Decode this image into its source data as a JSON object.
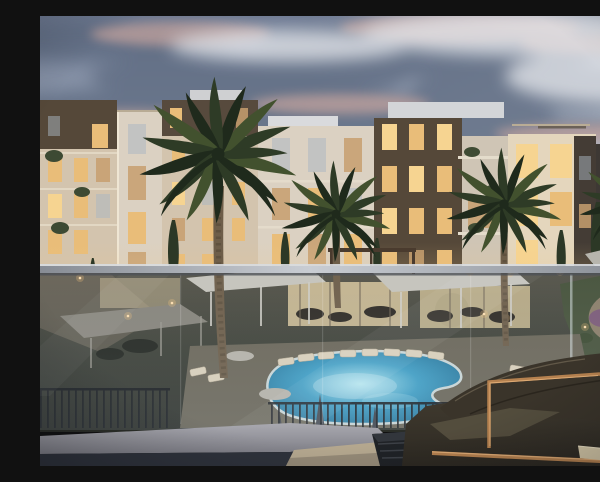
{
  "scene": {
    "setting": "Residential apartment compound at dusk viewed from a private balcony through a glass railing",
    "time_of_day": "dusk",
    "elements": [
      "evening sky with slate and pink-lit clouds",
      "four-to-five storey cream and dark-brown apartment buildings with warmly glowing windows and planted balconies",
      "tall palm trees and cypress trees",
      "white shade canopies and pergola pavilions in the courtyard",
      "illuminated free-form swimming pool with white coping",
      "rows of sun loungers and closed pool umbrellas",
      "lawn with winding path and purple and red flower beds",
      "dark picket pool fence",
      "full-width glass balustrade with metal handrail",
      "balcony ledge, side table and slatted box",
      "outdoor sofa with dark olive cushions, copper frame and light seat cushion"
    ],
    "counts": {
      "palm_trees": 4,
      "building_blocks": 8,
      "sun_loungers": 14,
      "pool_umbrellas": 6
    }
  },
  "palette": {
    "sky-top": "#6f7b93",
    "sky-mid": "#9aa5b7",
    "sky-low": "#c6cdd8",
    "sky-glow": "#dfe3e9",
    "cloud-dark": "#5f6c82",
    "cloud-pink": "#d8ada2",
    "cloud-light": "#e9ebef",
    "facade-cream": "#d3c4ae",
    "facade-light": "#e4d6bd",
    "facade-white": "#dbd1c2",
    "facade-dark": "#554839",
    "facade-charcoal": "#3d3834",
    "window-bright": "#f6d491",
    "window-lit": "#e9bd79",
    "window-dim": "#c79f6e",
    "window-cool": "#a9b6c2",
    "palm-dark": "#1f2a1c",
    "palm-mid": "#2e3b26",
    "palm-light": "#42512e",
    "trunk": "#6e5e49",
    "canopy-white": "#c7c5bd",
    "ground-dark": "#3c3f36",
    "deck": "#6b6658",
    "lawn": "#46523a",
    "path-warm": "#93836f",
    "pool-glow": "#aee8f2",
    "pool-mid": "#3f9fc6",
    "pool-deep": "#1b6287",
    "coping": "#cdd9d9",
    "lounger": "#ddd2bc",
    "umbrella-dark": "#3f434b",
    "rail-light": "#c9cdd3",
    "rail-dark": "#878c94",
    "ledge": "#a3a3aa",
    "floor-dark": "#2e323b",
    "sofa-dark": "#4e4739",
    "sofa-deep": "#2c2821",
    "cushion-light": "#d6c9a8",
    "frame-copper": "#b5814f",
    "copper-highlight": "#e8b57e",
    "light-warm": "#ffdfae",
    "flower-purple": "#7c5a78",
    "flower-red": "#a85f66",
    "tree-green": "#25301f"
  }
}
